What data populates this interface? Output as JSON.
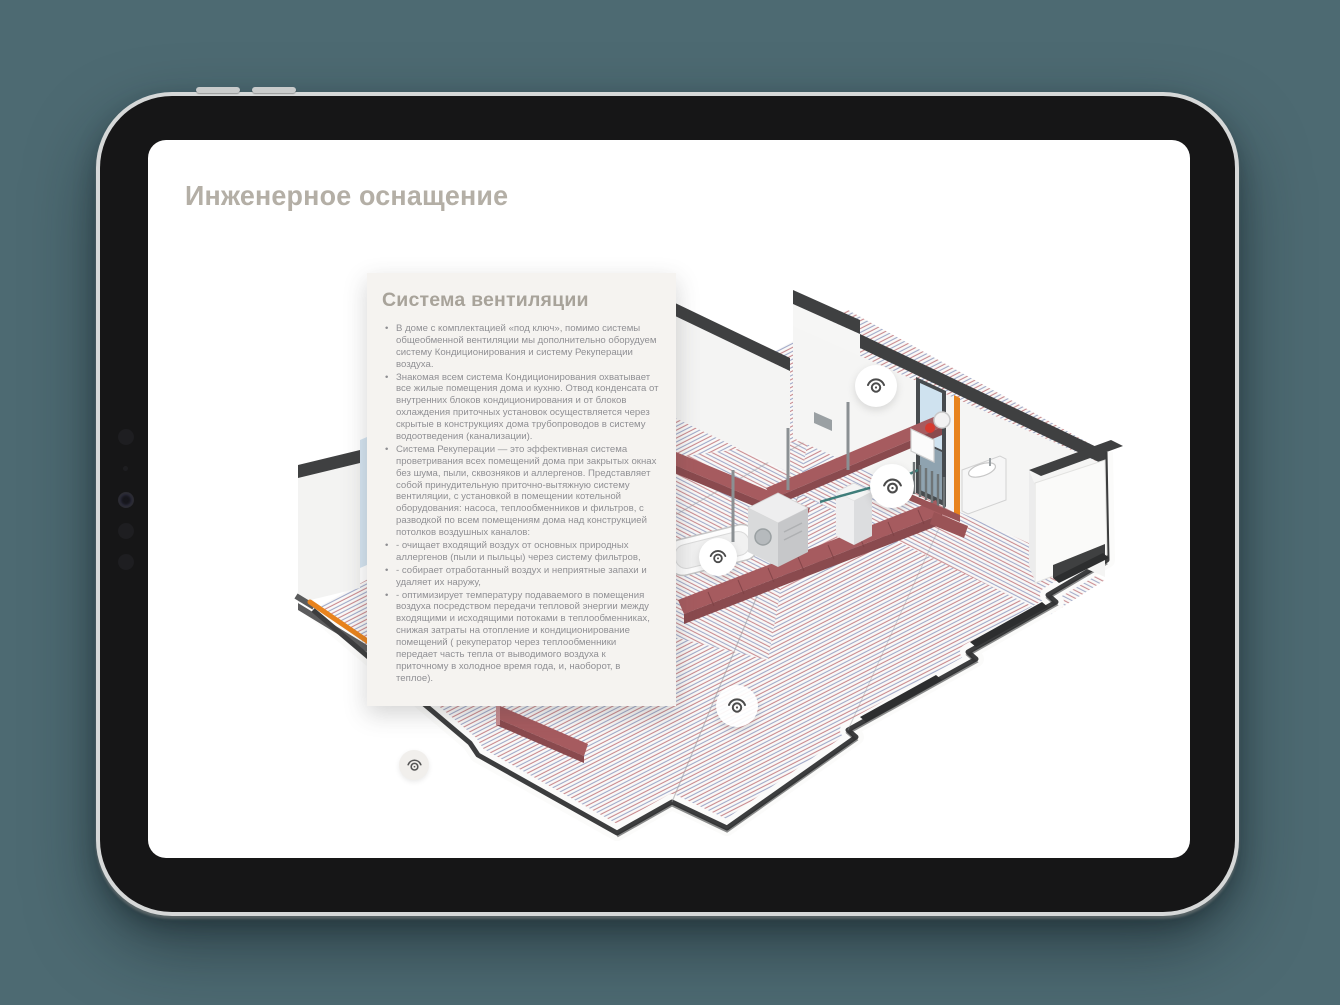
{
  "device": {
    "type": "tablet-mockup",
    "side_buttons": [
      "volume-button-1",
      "volume-button-2"
    ],
    "front_camera": "camera-array"
  },
  "page": {
    "title": "Инженерное оснащение"
  },
  "card": {
    "title": "Система вентиляции",
    "bullets": [
      "В доме с комплектацией «под ключ», помимо системы общеобменной вентиляции мы дополнительно оборудуем систему Кондиционирования и систему Рекуперации воздуха.",
      "Знакомая всем система Кондиционирования охватывает все жилые помещения дома и кухню. Отвод конденсата от внутренних блоков кондиционирования и от блоков охлаждения приточных установок осуществляется через скрытые в конструкциях дома трубопроводов в систему водоотведения (канализации).",
      "Система Рекуперации — это эффективная система проветривания всех помещений дома при закрытых окнах без шума, пыли, сквозняков и аллергенов. Представляет собой принудительную приточно-вытяжную систему вентиляции, с установкой в помещении котельной оборудования: насоса, теплообменников и фильтров, с разводкой по всем помещениям дома над конструкцией потолков воздушных каналов:",
      "- очищает входящий воздух от основных природных аллергенов (пыли и пыльцы) через систему фильтров,",
      "- собирает отработанный воздух и неприятные запахи и удаляет их наружу,",
      "- оптимизирует температуру подаваемого в помещения воздуха посредством передачи тепловой энергии между входящими и исходящими потоками в теплообменниках, снижая затраты на отопление и кондиционирование помещений ( рекуператор через теплообменники передает часть тепла от выводимого воздуха к приточному в холодное время года, и, наоборот, в теплое)."
    ]
  },
  "illustration": {
    "description": "isometric floor plan with underfloor heating coils, ventilation ducts, boiler room equipment",
    "hotspots": [
      {
        "id": "eye-hotspot-1",
        "icon": "eye-icon"
      },
      {
        "id": "eye-hotspot-2",
        "icon": "eye-icon"
      },
      {
        "id": "eye-hotspot-3",
        "icon": "eye-icon"
      },
      {
        "id": "eye-hotspot-4",
        "icon": "eye-icon"
      },
      {
        "id": "eye-hotspot-5",
        "icon": "eye-icon"
      }
    ]
  },
  "colors": {
    "background": "#4d6a72",
    "screen": "#ffffff",
    "title_text": "#b4afa6",
    "card_background": "#f5f3f0",
    "card_title": "#a8a39a",
    "card_text": "#909094",
    "wall_cap": "#3f4041",
    "duct": "#a65b5f",
    "coil_red": "#c47f84",
    "coil_blue": "#98a2c4",
    "accent_orange": "#e8831d",
    "window_glass": "#cfe2ef"
  }
}
